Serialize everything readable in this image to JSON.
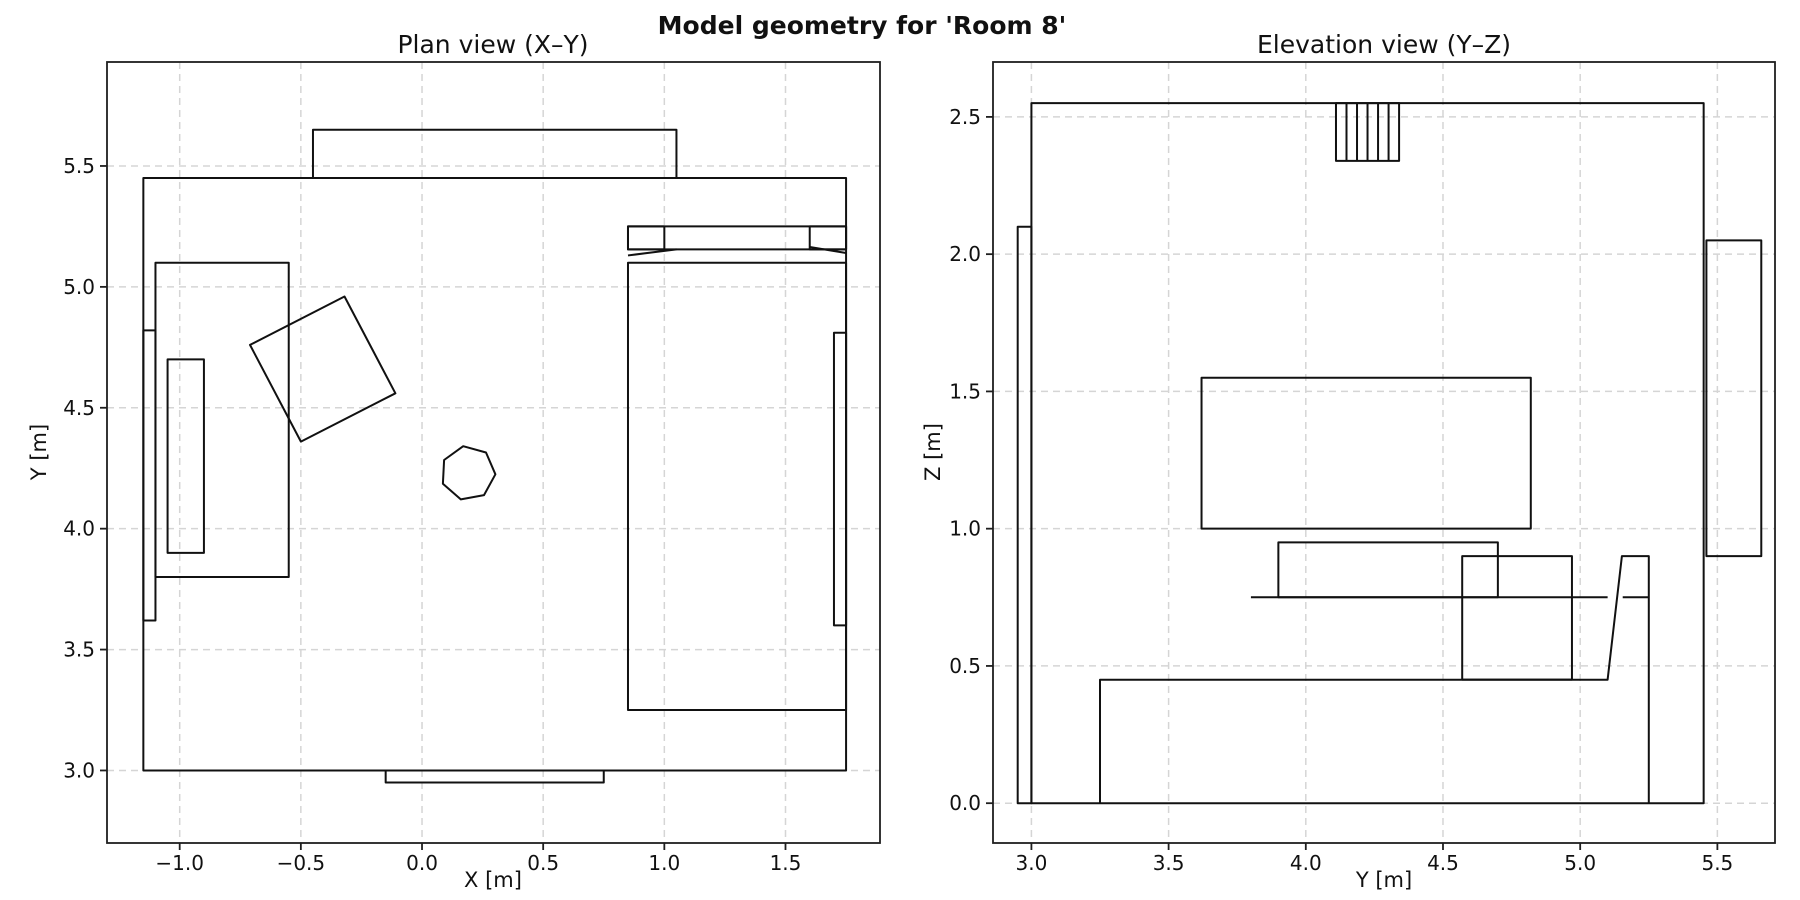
{
  "figure": {
    "suptitle": "Model geometry for 'Room 8'",
    "bg_color": "#ffffff",
    "line_color": "#111111",
    "spine_color": "#1f1f1f",
    "grid_color": "#d5d5d5",
    "text_color": "#111111"
  },
  "chart_data": [
    {
      "type": "line",
      "subtype": "2d-geometry-outlines",
      "axes_name": "plan-view-axes",
      "title": "Plan view (X–Y)",
      "xlabel": "X [m]",
      "ylabel": "Y [m]",
      "xlim": [
        -1.3,
        1.89
      ],
      "ylim": [
        2.7,
        5.93
      ],
      "grid": "dashed",
      "legend": "none",
      "xticks": {
        "values": [
          -1.0,
          -0.5,
          0.0,
          0.5,
          1.0,
          1.5
        ],
        "labels": [
          "−1.0",
          "−0.5",
          "0.0",
          "0.5",
          "1.0",
          "1.5"
        ]
      },
      "yticks": {
        "values": [
          3.0,
          3.5,
          4.0,
          4.5,
          5.0,
          5.5
        ],
        "labels": [
          "3.0",
          "3.5",
          "4.0",
          "4.5",
          "5.0",
          "5.5"
        ]
      },
      "px_box": {
        "left": 107,
        "top": 62,
        "width": 773,
        "height": 781
      },
      "shapes": [
        {
          "name": "plan-room-outline",
          "kind": "rect",
          "x1": -1.15,
          "y1": 3.0,
          "x2": 1.75,
          "y2": 5.45
        },
        {
          "name": "plan-window-ledge",
          "kind": "rect",
          "x1": -0.45,
          "y1": 5.45,
          "x2": 1.05,
          "y2": 5.65
        },
        {
          "name": "plan-door-sill",
          "kind": "rect",
          "x1": -0.15,
          "y1": 2.95,
          "x2": 0.75,
          "y2": 3.0
        },
        {
          "name": "plan-radiator-left",
          "kind": "rect",
          "x1": -1.15,
          "y1": 3.62,
          "x2": -1.1,
          "y2": 4.82
        },
        {
          "name": "plan-radiator-right",
          "kind": "rect",
          "x1": 1.7,
          "y1": 3.6,
          "x2": 1.75,
          "y2": 4.81
        },
        {
          "name": "plan-couch",
          "kind": "rect",
          "x1": -1.1,
          "y1": 3.8,
          "x2": -0.55,
          "y2": 5.1
        },
        {
          "name": "plan-couch-cushion",
          "kind": "rect",
          "x1": -1.05,
          "y1": 3.9,
          "x2": -0.9,
          "y2": 4.7
        },
        {
          "name": "plan-rotated-desk",
          "kind": "polygon",
          "points": [
            [
              -0.71,
              4.76
            ],
            [
              -0.32,
              4.96
            ],
            [
              -0.11,
              4.56
            ],
            [
              -0.5,
              4.36
            ]
          ]
        },
        {
          "name": "plan-stool-heptagon",
          "kind": "polygon",
          "points": [
            [
              0.17,
              4.341
            ],
            [
              0.091,
              4.284
            ],
            [
              0.086,
              4.186
            ],
            [
              0.16,
              4.121
            ],
            [
              0.256,
              4.139
            ],
            [
              0.303,
              4.225
            ],
            [
              0.264,
              4.315
            ]
          ]
        },
        {
          "name": "plan-bed",
          "kind": "rect",
          "x1": 0.85,
          "y1": 3.25,
          "x2": 1.75,
          "y2": 5.1
        },
        {
          "name": "plan-bed-headboard",
          "kind": "rect",
          "x1": 0.85,
          "y1": 5.155,
          "x2": 1.75,
          "y2": 5.25
        },
        {
          "name": "plan-pillow-left",
          "kind": "rect",
          "x1": 0.85,
          "y1": 5.155,
          "x2": 1.0,
          "y2": 5.25
        },
        {
          "name": "plan-pillow-right",
          "kind": "rect",
          "x1": 1.6,
          "y1": 5.155,
          "x2": 1.75,
          "y2": 5.25
        },
        {
          "name": "plan-blanket-fold-left",
          "kind": "line",
          "x1": 0.85,
          "y1": 5.13,
          "x2": 1.05,
          "y2": 5.155
        },
        {
          "name": "plan-blanket-fold-right",
          "kind": "line",
          "x1": 1.6,
          "y1": 5.165,
          "x2": 1.75,
          "y2": 5.14
        }
      ]
    },
    {
      "type": "line",
      "subtype": "2d-geometry-outlines",
      "axes_name": "elevation-view-axes",
      "title": "Elevation view (Y–Z)",
      "xlabel": "Y [m]",
      "ylabel": "Z [m]",
      "xlim": [
        2.86,
        5.71
      ],
      "ylim": [
        -0.145,
        2.7
      ],
      "grid": "dashed",
      "legend": "none",
      "xticks": {
        "values": [
          3.0,
          3.5,
          4.0,
          4.5,
          5.0,
          5.5
        ],
        "labels": [
          "3.0",
          "3.5",
          "4.0",
          "4.5",
          "5.0",
          "5.5"
        ]
      },
      "yticks": {
        "values": [
          0.0,
          0.5,
          1.0,
          1.5,
          2.0,
          2.5
        ],
        "labels": [
          "0.0",
          "0.5",
          "1.0",
          "1.5",
          "2.0",
          "2.5"
        ]
      },
      "px_box": {
        "left": 993,
        "top": 62,
        "width": 782,
        "height": 781
      },
      "shapes": [
        {
          "name": "elev-room-outline",
          "kind": "rect",
          "x1": 3.0,
          "y1": 0.0,
          "x2": 5.45,
          "y2": 2.55
        },
        {
          "name": "elev-door",
          "kind": "rect",
          "x1": 2.95,
          "y1": 0.0,
          "x2": 3.0,
          "y2": 2.1
        },
        {
          "name": "elev-ceiling-vent",
          "kind": "rect",
          "x1": 4.11,
          "y1": 2.34,
          "x2": 4.34,
          "y2": 2.55
        },
        {
          "name": "elev-ceiling-vent-hatch",
          "kind": "hatch-v",
          "x1": 4.11,
          "x2": 4.34,
          "y1": 2.34,
          "y2": 2.55,
          "n": 5
        },
        {
          "name": "elev-window",
          "kind": "rect",
          "x1": 5.46,
          "y1": 0.9,
          "x2": 5.66,
          "y2": 2.05
        },
        {
          "name": "elev-wall-panel",
          "kind": "rect",
          "x1": 3.62,
          "y1": 1.0,
          "x2": 4.82,
          "y2": 1.55
        },
        {
          "name": "elev-couch-back",
          "kind": "rect",
          "x1": 3.9,
          "y1": 0.75,
          "x2": 4.7,
          "y2": 0.95
        },
        {
          "name": "elev-seat-line",
          "kind": "line",
          "x1": 3.8,
          "y1": 0.75,
          "x2": 5.1,
          "y2": 0.75
        },
        {
          "name": "elev-seat-line-right",
          "kind": "line",
          "x1": 5.155,
          "y1": 0.75,
          "x2": 5.25,
          "y2": 0.75
        },
        {
          "name": "elev-ottoman",
          "kind": "rect",
          "x1": 4.57,
          "y1": 0.45,
          "x2": 4.97,
          "y2": 0.9
        },
        {
          "name": "elev-bed-profile",
          "kind": "polyline",
          "points": [
            [
              3.25,
              0.0
            ],
            [
              3.25,
              0.45
            ],
            [
              5.1,
              0.45
            ],
            [
              5.152,
              0.9
            ],
            [
              5.25,
              0.9
            ],
            [
              5.25,
              0.0
            ]
          ]
        }
      ]
    }
  ]
}
